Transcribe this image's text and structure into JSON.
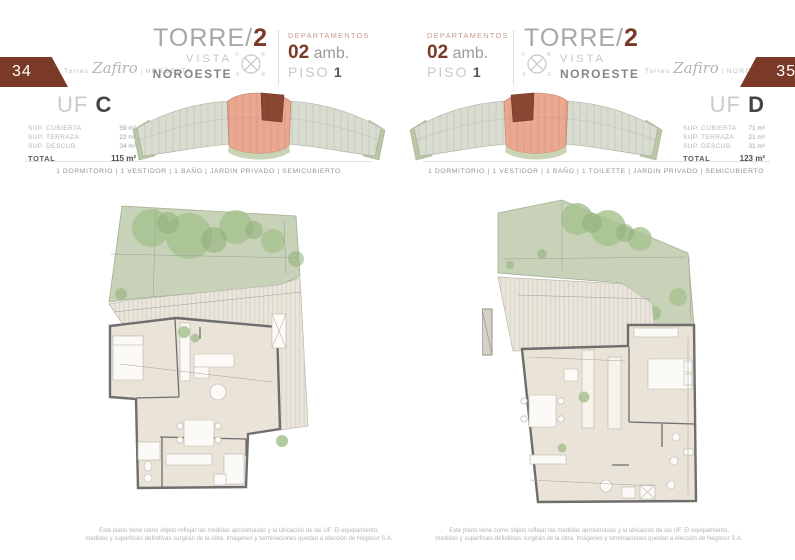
{
  "brand": {
    "prefix": "Torres",
    "script": "Zafiro",
    "divider": "|",
    "suffix": "NORDELTA"
  },
  "compass": {
    "n": "N",
    "e": "E",
    "s": "S",
    "o": "O"
  },
  "pages": [
    {
      "number": "34",
      "torre_label": "TORRE/",
      "torre_number": "2",
      "vista_label": "VISTA",
      "orientation": "NOROESTE",
      "dept_label": "DEPARTAMENTOS",
      "amb_value": "02",
      "amb_unit": "amb.",
      "piso_label": "PISO",
      "piso_value": "1",
      "uf_label": "UF",
      "uf_letter": "C",
      "surfaces": [
        {
          "label": "SUP. CUBIERTA",
          "value": "59 m²"
        },
        {
          "label": "SUP. TERRAZA",
          "value": "22 m²"
        },
        {
          "label": "SUP. DESCUB.",
          "value": "34 m²"
        }
      ],
      "total_label": "TOTAL",
      "total_value": "115 m²",
      "features": "1 DORMITORIO | 1 VESTIDOR | 1 BAÑO | JARDIN PRIVADO | SEMICUBIERTO"
    },
    {
      "number": "35",
      "torre_label": "TORRE/",
      "torre_number": "2",
      "vista_label": "VISTA",
      "orientation": "NOROESTE",
      "dept_label": "DEPARTAMENTOS",
      "amb_value": "02",
      "amb_unit": "amb.",
      "piso_label": "PISO",
      "piso_value": "1",
      "uf_label": "UF",
      "uf_letter": "D",
      "surfaces": [
        {
          "label": "SUP. CUBIERTA",
          "value": "71 m²"
        },
        {
          "label": "SUP. TERRAZA",
          "value": "21 m²"
        },
        {
          "label": "SUP. DESCUB.",
          "value": "31 m²"
        }
      ],
      "total_label": "TOTAL",
      "total_value": "123 m²",
      "features": "1 DORMITORIO | 1 VESTIDOR | 1 BAÑO | 1 TOILETTE | JARDIN PRIVADO | SEMICUBIERTO"
    }
  ],
  "footer": {
    "line1": "Este plano tiene como objeto reflejar las medidas aproximadas y la ubicación de las UF. El equipamiento,",
    "line2": "medidas y superficies definitivas surgirán de la obra. Imágenes y terminaciones quedan a elección de Negocor S.A."
  },
  "colors": {
    "maroon": "#7b3a27",
    "salmon": "#eba78f",
    "dark_unit": "#8a4531",
    "garden_green": "#c7d2b8",
    "deck": "#e9e5db",
    "unit_floor": "#eae3d8",
    "wall": "#6e6e6e"
  }
}
